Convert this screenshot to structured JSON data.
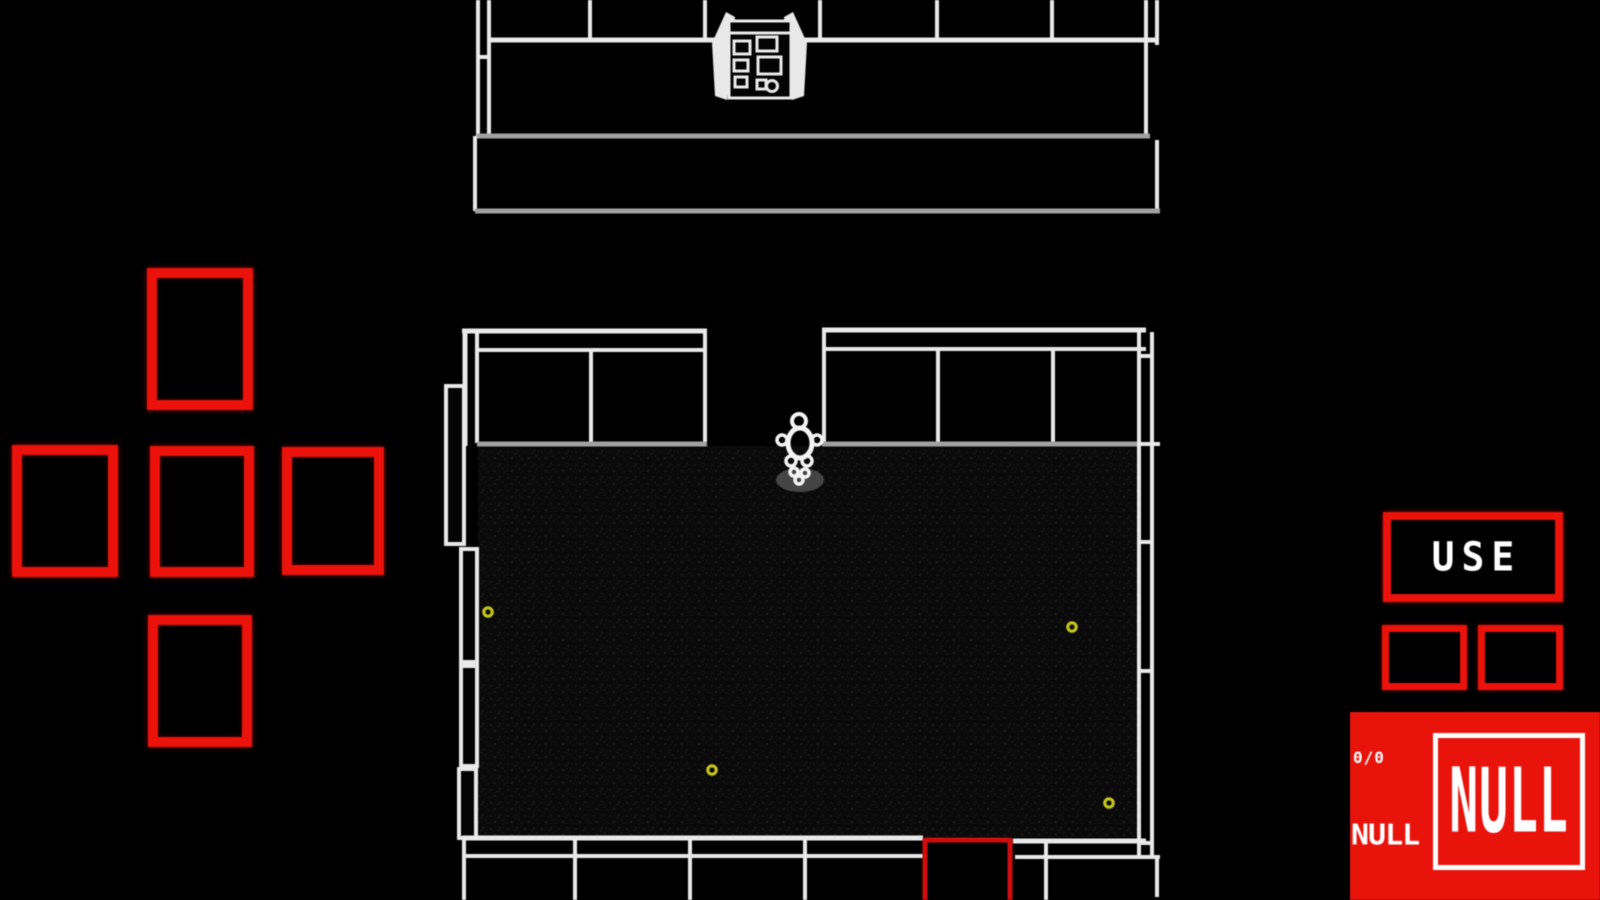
{
  "hud": {
    "use_button_label": "USE",
    "ammo_counter": "0/0",
    "weapon_small_label": "NULL",
    "weapon_large_label": "NULL"
  },
  "dpad": {
    "directions": [
      "up",
      "left",
      "center",
      "right",
      "down"
    ]
  },
  "colors": {
    "accent_red": "#ea120b",
    "panel_red": "#e8140c",
    "door_red": "#cf0d0d",
    "wall_white": "#e9e9e9",
    "wall_gray": "#a0a0a0",
    "item_yellow": "#c3c31c",
    "shadow_gray": "#4a4a4a",
    "text_white": "#ffffff",
    "floor_base": "#0a0a0a"
  },
  "entities": {
    "player": {
      "x": 800,
      "y": 447
    },
    "items": [
      {
        "x": 488,
        "y": 612
      },
      {
        "x": 1072,
        "y": 627
      },
      {
        "x": 712,
        "y": 770
      },
      {
        "x": 1109,
        "y": 803
      }
    ],
    "exit_door": {
      "x": 925,
      "y": 838,
      "width": 86
    }
  }
}
